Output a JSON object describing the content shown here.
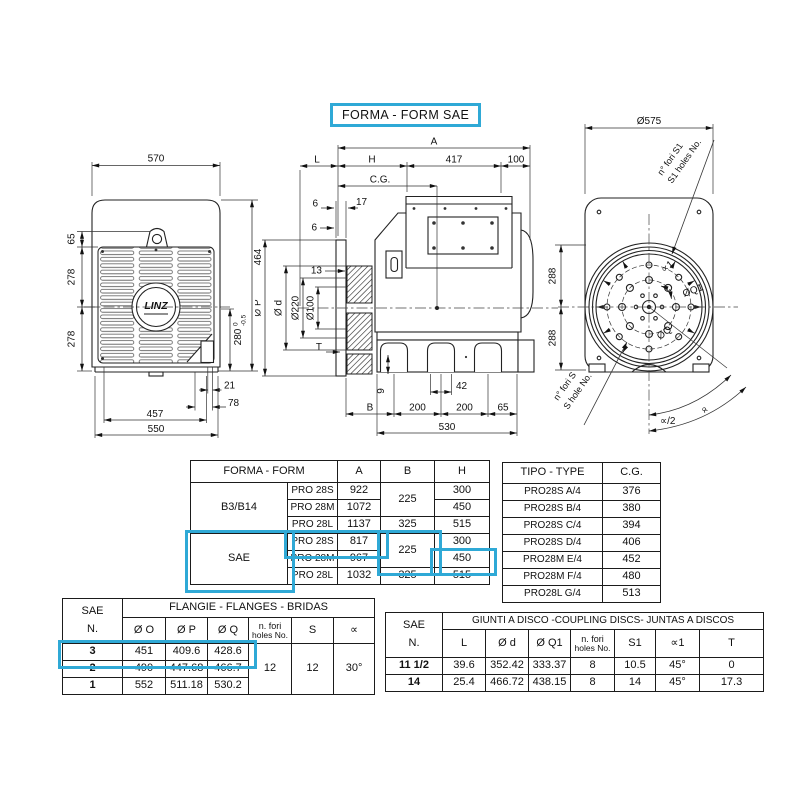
{
  "accent": "#2fa9d6",
  "title": "FORMA - FORM  SAE",
  "left_view": {
    "logo": "LINZ",
    "d570": "570",
    "d65": "65",
    "d278a": "278",
    "d278b": "278",
    "d464": "464",
    "d280": "280",
    "tol_hi": "0",
    "tol_lo": "-0.5",
    "d21": "21",
    "d78": "78",
    "d457": "457",
    "d550": "550"
  },
  "side_view": {
    "dA": "A",
    "dL": "L",
    "dH": "H",
    "d417": "417",
    "d100": "100",
    "cg": "C.G.",
    "d6a": "6",
    "d17": "17",
    "d6b": "6",
    "d13": "13",
    "dP": "Ø P",
    "dd": "Ø d",
    "d220": "Ø220",
    "d100b": "Ø100",
    "dT": "T",
    "dB": "B",
    "d9": "9",
    "d42": "42",
    "d200a": "200",
    "d200b": "200",
    "d65": "65",
    "d530": "530"
  },
  "end_view": {
    "d575": "Ø575",
    "d288a": "288",
    "d288b": "288",
    "fori_s1_a": "n° fori S1",
    "fori_s1_b": "S1 holes No.",
    "fori_s_a": "n° fori S",
    "fori_s_b": "S hole No.",
    "alpha1": "∝1",
    "dq1": "ØQ1",
    "dq": "ØQ",
    "alpha_half": "∝/2",
    "alpha": "∝"
  },
  "forma_table": {
    "header_title": "FORMA - FORM",
    "col_a": "A",
    "col_b": "B",
    "col_h": "H",
    "g1_name": "B3/B14",
    "g1_b": "225",
    "g1": [
      {
        "model": "PRO 28S",
        "a": "922",
        "h": "300"
      },
      {
        "model": "PRO 28M",
        "a": "1072",
        "h": "450"
      },
      {
        "model": "PRO 28L",
        "a": "1137",
        "b": "325",
        "h": "515"
      }
    ],
    "g2_name": "SAE",
    "g2_b": "225",
    "g2": [
      {
        "model": "PRO 28S",
        "a": "817",
        "h": "300"
      },
      {
        "model": "PRO 28M",
        "a": "967",
        "h": "450"
      },
      {
        "model": "PRO 28L",
        "a": "1032",
        "b": "325",
        "h": "515"
      }
    ]
  },
  "tipo_table": {
    "header_type": "TIPO - TYPE",
    "header_cg": "C.G.",
    "rows": [
      {
        "type": "PRO28S A/4",
        "cg": "376"
      },
      {
        "type": "PRO28S B/4",
        "cg": "380"
      },
      {
        "type": "PRO28S C/4",
        "cg": "394"
      },
      {
        "type": "PRO28S D/4",
        "cg": "406"
      },
      {
        "type": "PRO28M E/4",
        "cg": "452"
      },
      {
        "type": "PRO28M F/4",
        "cg": "480"
      },
      {
        "type": "PRO28L G/4",
        "cg": "513"
      }
    ]
  },
  "flange_table": {
    "sae": "SAE",
    "n": "N.",
    "title": "FLANGIE  - FLANGES - BRIDAS",
    "col_o": "Ø O",
    "col_p": "Ø P",
    "col_q": "Ø Q",
    "col_fori_1": "n. fori",
    "col_fori_2": "holes No.",
    "col_s": "S",
    "col_alpha": "∝",
    "rows": [
      {
        "n": "3",
        "o": "451",
        "p": "409.6",
        "q": "428.6"
      },
      {
        "n": "2",
        "o": "490",
        "p": "447.68",
        "q": "466.7"
      },
      {
        "n": "1",
        "o": "552",
        "p": "511.18",
        "q": "530.2"
      }
    ],
    "fori": "12",
    "s": "12",
    "alpha": "30°"
  },
  "disc_table": {
    "sae": "SAE",
    "n": "N.",
    "title": "GIUNTI A DISCO -COUPLING DISCS- JUNTAS A DISCOS",
    "col_l": "L",
    "col_d": "Ø d",
    "col_q1": "Ø Q1",
    "col_fori_1": "n. fori",
    "col_fori_2": "holes No.",
    "col_s1": "S1",
    "col_alpha1": "∝1",
    "col_t": "T",
    "rows": [
      {
        "n": "11 1/2",
        "l": "39.6",
        "d": "352.42",
        "q1": "333.37",
        "fori": "8",
        "s1": "10.5",
        "a1": "45°",
        "t": "0"
      },
      {
        "n": "14",
        "l": "25.4",
        "d": "466.72",
        "q1": "438.15",
        "fori": "8",
        "s1": "14",
        "a1": "45°",
        "t": "17.3"
      }
    ]
  }
}
